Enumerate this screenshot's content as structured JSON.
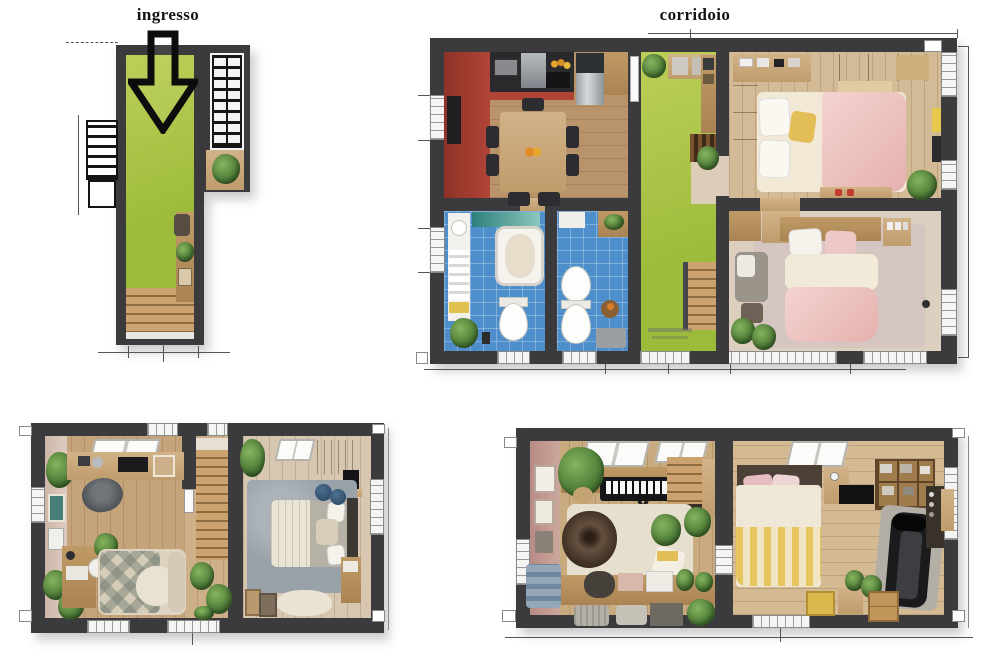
{
  "page": {
    "background": "#ffffff",
    "description": "Four 3D top-down floor-plan renders of a multi-level home"
  },
  "labels": {
    "ingresso": "ingresso",
    "corridoio": "corridoio"
  },
  "colors": {
    "wall": "#3b3b3d",
    "corridor_green": "#9cbb3a",
    "corridor_green_light": "#bccf58",
    "tile_blue": "#4d8ecb",
    "kitchen_red": "#b04437",
    "bed_pink": "#e5b1ae",
    "wood_floor": "#c6a47b",
    "accent_yellow": "#e3be56",
    "plant_green": "#4c7a36"
  },
  "plans": [
    {
      "id": "entry-level",
      "label": "ingresso",
      "rooms": [
        "entry-corridor",
        "stairwell",
        "external-stair"
      ],
      "features": [
        "green-floor",
        "entrance-down-arrow",
        "wood-stairs",
        "planter",
        "console-table"
      ]
    },
    {
      "id": "main-level",
      "label": "corridoio",
      "rooms": [
        "kitchen-dining",
        "bathroom-1",
        "bathroom-2",
        "corridor",
        "bedroom-1",
        "bedroom-2"
      ],
      "features": [
        "red-kitchen-cabinets",
        "dining-table-six-chairs",
        "fridge",
        "bathtub",
        "toilet",
        "bidet",
        "double-bed-pink",
        "wardrobe",
        "staircase",
        "green-corridor-floor"
      ]
    },
    {
      "id": "lower-left-level",
      "rooms": [
        "studio-living-room",
        "staircase",
        "bedroom"
      ],
      "features": [
        "skylights",
        "desk",
        "radio",
        "armchair",
        "sofa-diamond-plaid",
        "double-bed-grey",
        "rugs",
        "plants",
        "picture-frames"
      ]
    },
    {
      "id": "lower-right-level",
      "rooms": [
        "music-room",
        "bedroom-gym"
      ],
      "features": [
        "keyboard-piano",
        "bean-bag",
        "storage-bench",
        "skylights",
        "bed-yellow-striped-blanket",
        "treadmill",
        "cube-shelf",
        "clothes-rack",
        "plants"
      ]
    }
  ]
}
